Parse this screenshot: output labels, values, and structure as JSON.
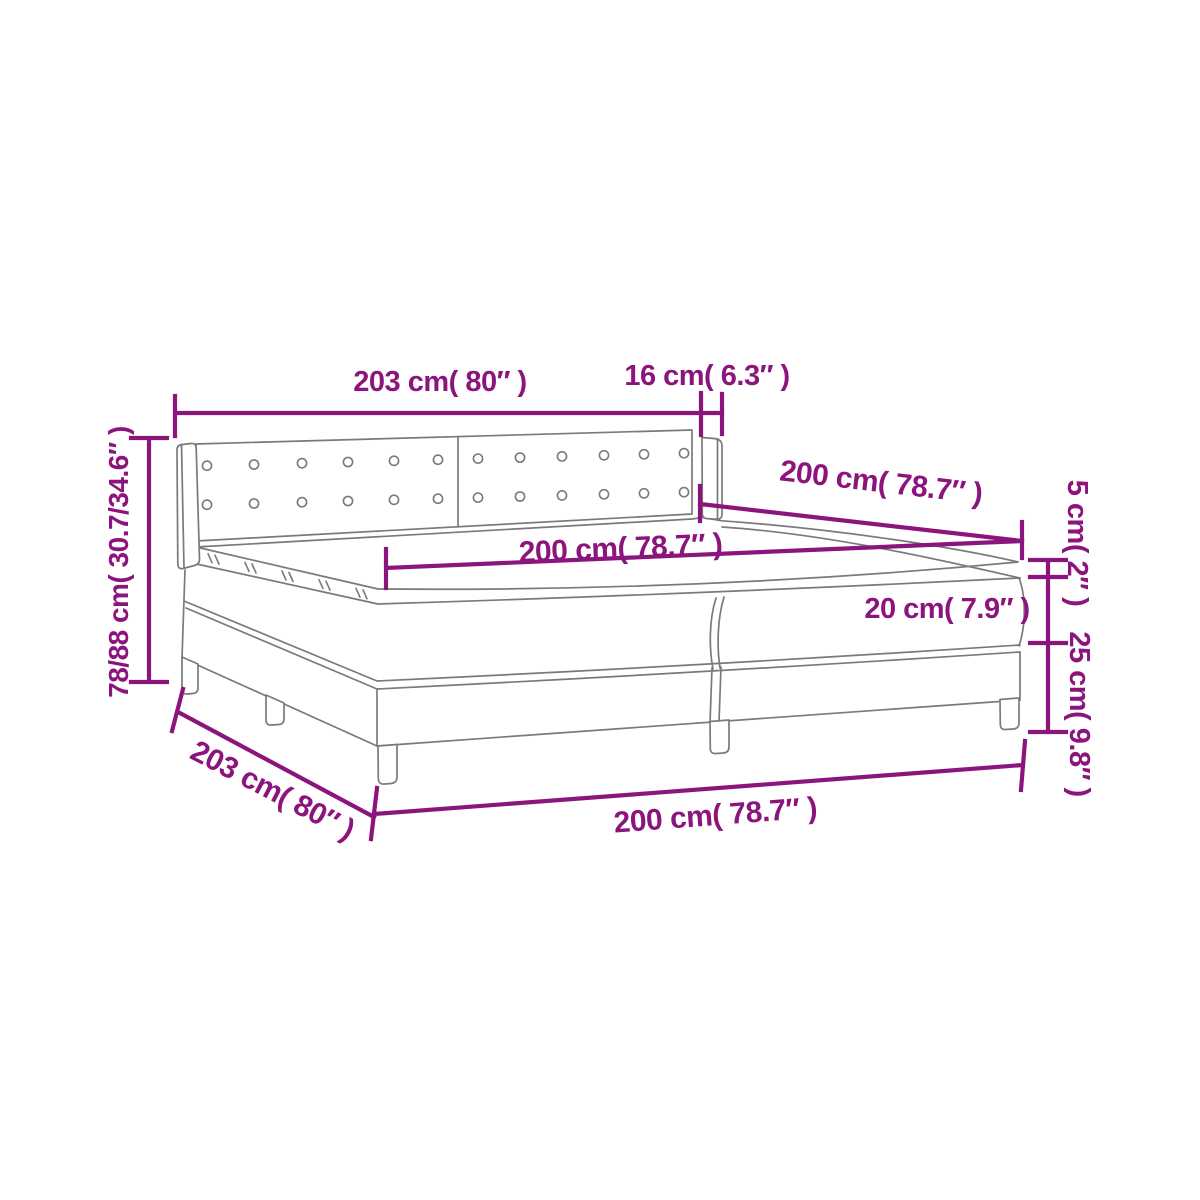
{
  "colors": {
    "dimension": "#8c157d",
    "outline": "#7a7a7a",
    "background": "#ffffff"
  },
  "diagram": {
    "type": "product-dimension-diagram",
    "subject": "box-spring-bed-with-headboard",
    "dims": {
      "headboard_width": {
        "label": "203 cm( 80″ )",
        "value_cm": "203",
        "value_in": "80"
      },
      "wing_depth": {
        "label": "16 cm( 6.3″ )",
        "value_cm": "16",
        "value_in": "6.3"
      },
      "bed_height": {
        "label": "78/88 cm( 30.7/34.6″ )",
        "value_cm": "78/88",
        "value_in": "30.7/34.6"
      },
      "mattress_width": {
        "label": "200 cm( 78.7″ )",
        "value_cm": "200",
        "value_in": "78.7"
      },
      "bed_length": {
        "label": "200 cm( 78.7″ )",
        "value_cm": "200",
        "value_in": "78.7"
      },
      "topper_height": {
        "label": "5 cm( 2″ )",
        "value_cm": "5",
        "value_in": "2"
      },
      "mattress_height": {
        "label": "20 cm( 7.9″ )",
        "value_cm": "20",
        "value_in": "7.9"
      },
      "base_height": {
        "label": "25 cm( 9.8″ )",
        "value_cm": "25",
        "value_in": "9.8"
      },
      "side_length": {
        "label": "203 cm( 80″ )",
        "value_cm": "203",
        "value_in": "80"
      },
      "base_width": {
        "label": "200 cm( 78.7″ )",
        "value_cm": "200",
        "value_in": "78.7"
      }
    },
    "headboard": {
      "button_rows": 2,
      "buttons_per_row": 12
    }
  }
}
